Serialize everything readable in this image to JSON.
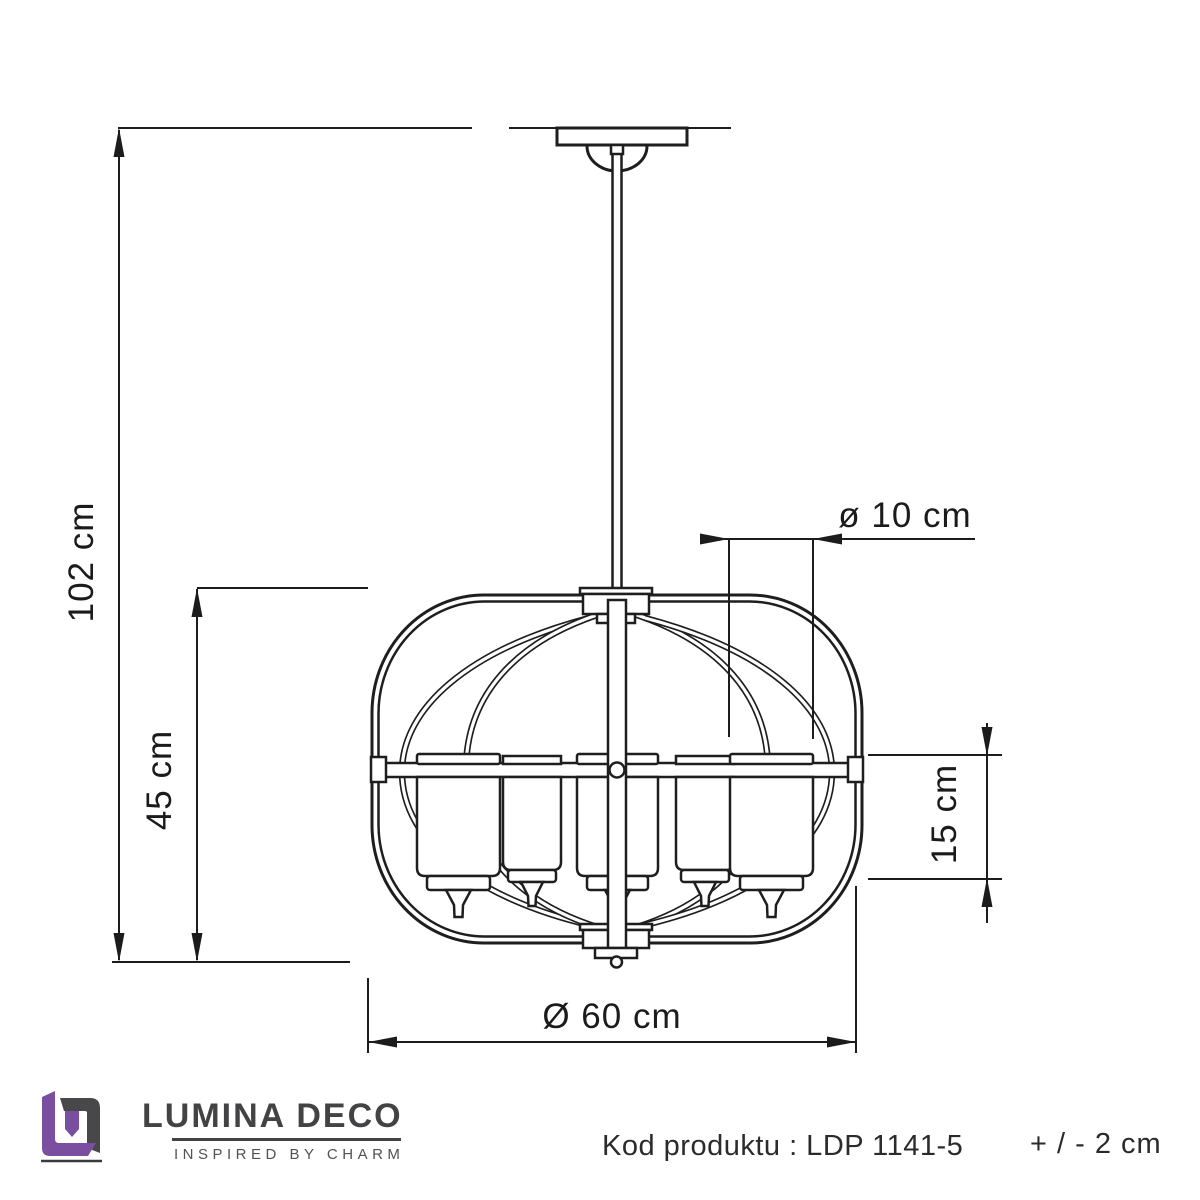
{
  "diagram": {
    "type": "product-dimension-drawing",
    "subject": "pendant chandelier with 5 cylindrical shades",
    "dimensions": {
      "total_height": "102 cm",
      "body_height": "45 cm",
      "shade_diameter": "ø 10 cm",
      "shade_height": "15 cm",
      "body_diameter": "Ø 60 cm"
    }
  },
  "footer": {
    "brand": {
      "name": "LUMINA DECO",
      "tagline": "INSPIRED BY CHARM"
    },
    "product_code": "Kod produktu : LDP 1141-5",
    "tolerance": "+ / - 2 cm"
  },
  "colors": {
    "line": "#1e1e1e",
    "brand_purple": "#7b4fa0",
    "brand_gray": "#48484a",
    "footer_text": "#2b2b2d"
  }
}
